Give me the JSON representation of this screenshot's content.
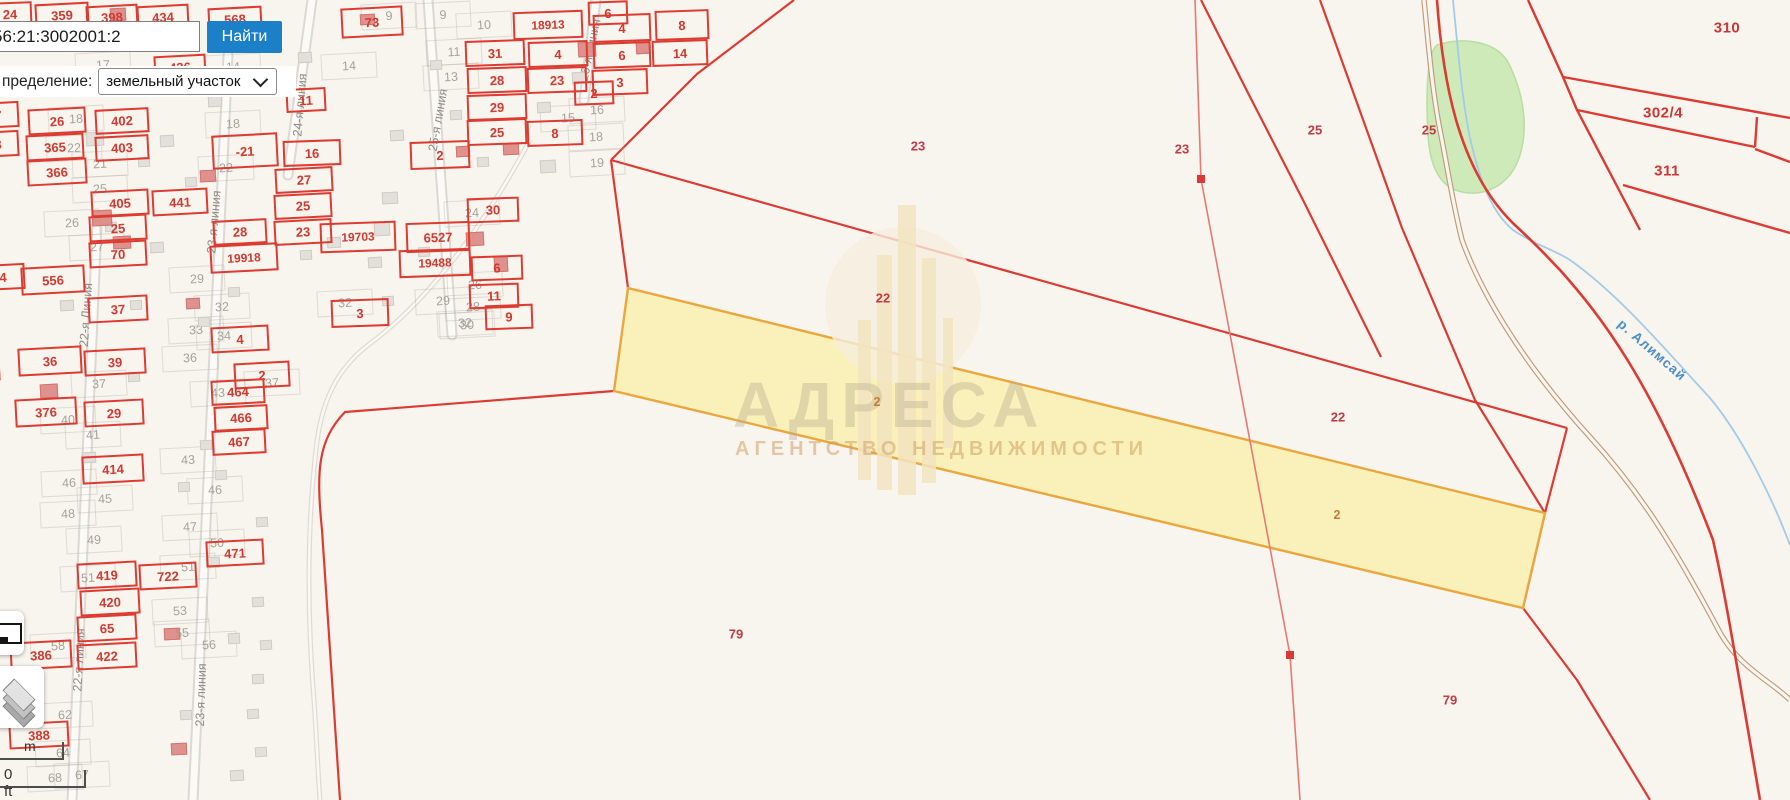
{
  "search": {
    "value": "56:21:3002001:2",
    "button_label": "Найти",
    "filter_label": "пределение:",
    "filter_value": "земельный участок"
  },
  "controls": {
    "scale_m": "m",
    "scale_ft": "0 ft",
    "icons": {
      "layers": "layers-icon",
      "minimap": "minimap-icon",
      "dropdown": "chevron-down-icon"
    }
  },
  "watermark": {
    "title": "АДРЕСА",
    "subtitle": "АГЕНТСТВО НЕДВИЖИМОСТИ"
  },
  "colors": {
    "parcel_red": "#dd3b31",
    "selected_fill": "#f9efab",
    "selected_border": "#eba63e",
    "accent_blue": "#1c80c9",
    "river_blue": "#a3cbe9",
    "green_area": "#cdeab8"
  },
  "map": {
    "river_label": "р. Алимсай",
    "selected_parcel_label": "2",
    "parcels": [
      [
        "24",
        10,
        14,
        44,
        24,
        -2
      ],
      [
        "359",
        62,
        15,
        54,
        24,
        -3
      ],
      [
        "398",
        112,
        17,
        52,
        24,
        -3
      ],
      [
        "434",
        163,
        17,
        52,
        24,
        -3
      ],
      [
        "568",
        235,
        19,
        54,
        24,
        -3
      ],
      [
        "73",
        372,
        22,
        62,
        30,
        -3
      ],
      [
        "18913",
        548,
        25,
        70,
        28,
        -2
      ],
      [
        "4",
        622,
        28,
        58,
        28,
        -2
      ],
      [
        "8",
        682,
        25,
        54,
        30,
        -2
      ],
      [
        "31",
        495,
        53,
        60,
        26,
        -2
      ],
      [
        "4",
        558,
        54,
        60,
        26,
        -2
      ],
      [
        "6",
        622,
        55,
        58,
        26,
        -2
      ],
      [
        "14",
        680,
        53,
        56,
        26,
        -2
      ],
      [
        "28",
        497,
        80,
        60,
        26,
        -2
      ],
      [
        "23",
        557,
        80,
        60,
        26,
        -2
      ],
      [
        "3",
        620,
        82,
        56,
        26,
        -2
      ],
      [
        "29",
        497,
        107,
        60,
        26,
        -2
      ],
      [
        "25",
        497,
        132,
        60,
        26,
        -2
      ],
      [
        "8",
        555,
        133,
        56,
        26,
        -2
      ],
      [
        "436",
        180,
        67,
        52,
        24,
        -3
      ],
      [
        "11",
        306,
        100,
        40,
        24,
        -3
      ],
      [
        "26",
        57,
        121,
        58,
        26,
        -3
      ],
      [
        "402",
        122,
        121,
        54,
        25,
        -3
      ],
      [
        "7",
        -2,
        115,
        42,
        26,
        -3
      ],
      [
        "365",
        55,
        147,
        58,
        26,
        -3
      ],
      [
        "8",
        -2,
        144,
        42,
        26,
        -3
      ],
      [
        "403",
        122,
        148,
        54,
        25,
        -3
      ],
      [
        "366",
        57,
        172,
        60,
        26,
        -3
      ],
      [
        "-21",
        245,
        151,
        66,
        34,
        -3
      ],
      [
        "27",
        304,
        180,
        58,
        25,
        -3
      ],
      [
        "25",
        303,
        206,
        58,
        25,
        -3
      ],
      [
        "23",
        303,
        232,
        58,
        25,
        -3
      ],
      [
        "441",
        180,
        202,
        56,
        26,
        -3
      ],
      [
        "405",
        120,
        203,
        58,
        26,
        -3
      ],
      [
        "25",
        118,
        228,
        58,
        26,
        -3
      ],
      [
        "70",
        118,
        254,
        58,
        26,
        -3
      ],
      [
        "28",
        240,
        232,
        54,
        25,
        -3
      ],
      [
        "19918",
        244,
        258,
        68,
        28,
        -3
      ],
      [
        "19703",
        358,
        237,
        76,
        30,
        -2
      ],
      [
        "6527",
        438,
        237,
        64,
        30,
        -2
      ],
      [
        "19488",
        435,
        263,
        72,
        28,
        -2
      ],
      [
        "30",
        493,
        210,
        52,
        25,
        -2
      ],
      [
        "6",
        497,
        268,
        52,
        25,
        -2
      ],
      [
        "11",
        494,
        296,
        50,
        25,
        -2
      ],
      [
        "9",
        509,
        317,
        48,
        25,
        -2
      ],
      [
        "3",
        360,
        313,
        58,
        28,
        -2
      ],
      [
        "16",
        312,
        153,
        58,
        26,
        -2
      ],
      [
        "2",
        440,
        155,
        60,
        28,
        -2
      ],
      [
        "4",
        3,
        277,
        44,
        26,
        -3
      ],
      [
        "556",
        53,
        280,
        64,
        28,
        -3
      ],
      [
        "37",
        118,
        309,
        60,
        26,
        -3
      ],
      [
        "36",
        50,
        361,
        64,
        28,
        -3
      ],
      [
        "39",
        115,
        362,
        62,
        26,
        -3
      ],
      [
        "376",
        46,
        412,
        62,
        28,
        -3
      ],
      [
        "29",
        114,
        413,
        60,
        26,
        -3
      ],
      [
        "4",
        240,
        339,
        58,
        26,
        -3
      ],
      [
        "2",
        262,
        375,
        56,
        26,
        -3
      ],
      [
        "464",
        238,
        392,
        54,
        25,
        -3
      ],
      [
        "466",
        241,
        418,
        54,
        25,
        -3
      ],
      [
        "467",
        239,
        442,
        54,
        25,
        -3
      ],
      [
        "414",
        113,
        469,
        62,
        28,
        -3
      ],
      [
        "471",
        235,
        553,
        58,
        26,
        -3
      ],
      [
        "419",
        107,
        575,
        60,
        26,
        -3
      ],
      [
        "722",
        168,
        576,
        58,
        26,
        -3
      ],
      [
        "420",
        110,
        602,
        60,
        26,
        -3
      ],
      [
        "65",
        107,
        628,
        60,
        26,
        -3
      ],
      [
        "386",
        41,
        655,
        62,
        28,
        -3
      ],
      [
        "422",
        107,
        656,
        60,
        26,
        -3
      ],
      [
        "388",
        39,
        735,
        60,
        26,
        -3
      ],
      [
        "",
        -14,
        368,
        28,
        26,
        -3
      ],
      [
        "",
        -16,
        401,
        28,
        28,
        -3
      ],
      [
        "6",
        608,
        13,
        40,
        24,
        -2
      ],
      [
        "2",
        594,
        93,
        40,
        24,
        -2
      ]
    ],
    "gray_numbers": [
      [
        "17",
        103,
        65
      ],
      [
        "14",
        233,
        67
      ],
      [
        "14",
        349,
        66
      ],
      [
        "9",
        389,
        16
      ],
      [
        "9",
        443,
        15
      ],
      [
        "10",
        484,
        25
      ],
      [
        "11",
        454,
        52
      ],
      [
        "13",
        451,
        77
      ],
      [
        "15",
        568,
        118
      ],
      [
        "16",
        597,
        110
      ],
      [
        "18",
        596,
        137
      ],
      [
        "19",
        597,
        163
      ],
      [
        "18",
        76,
        119
      ],
      [
        "22",
        74,
        148
      ],
      [
        "21",
        100,
        164
      ],
      [
        "18",
        233,
        124
      ],
      [
        "22",
        226,
        168
      ],
      [
        "25",
        100,
        189
      ],
      [
        "26",
        72,
        223
      ],
      [
        "27",
        97,
        247
      ],
      [
        "29",
        197,
        279
      ],
      [
        "32",
        222,
        307
      ],
      [
        "33",
        196,
        330
      ],
      [
        "34",
        224,
        336
      ],
      [
        "36",
        190,
        358
      ],
      [
        "37",
        99,
        384
      ],
      [
        "37",
        272,
        383
      ],
      [
        "40",
        68,
        420
      ],
      [
        "41",
        93,
        435
      ],
      [
        "43",
        188,
        460
      ],
      [
        "43",
        218,
        393
      ],
      [
        "46",
        69,
        483
      ],
      [
        "46",
        215,
        490
      ],
      [
        "45",
        105,
        499
      ],
      [
        "48",
        68,
        514
      ],
      [
        "47",
        190,
        527
      ],
      [
        "49",
        94,
        540
      ],
      [
        "50",
        217,
        543
      ],
      [
        "51",
        88,
        578
      ],
      [
        "51",
        188,
        567
      ],
      [
        "53",
        180,
        611
      ],
      [
        "55",
        182,
        633
      ],
      [
        "56",
        209,
        645
      ],
      [
        "58",
        58,
        646
      ],
      [
        "62",
        65,
        715
      ],
      [
        "64",
        63,
        753
      ],
      [
        "67",
        82,
        775
      ],
      [
        "68",
        55,
        778
      ],
      [
        "24",
        472,
        213
      ],
      [
        "26",
        475,
        285
      ],
      [
        "28",
        473,
        307
      ],
      [
        "29",
        443,
        301
      ],
      [
        "30",
        467,
        325
      ],
      [
        "32",
        345,
        303
      ],
      [
        "32",
        465,
        323
      ]
    ],
    "area_labels": [
      [
        "23",
        918,
        146,
        "p"
      ],
      [
        "23",
        1182,
        149,
        "p"
      ],
      [
        "25",
        1315,
        130,
        "p"
      ],
      [
        "22",
        883,
        298,
        "p"
      ],
      [
        "22",
        1338,
        417,
        "p"
      ],
      [
        "2",
        877,
        402,
        "o"
      ],
      [
        "2",
        1337,
        515,
        "o"
      ],
      [
        "79",
        736,
        634,
        "p"
      ],
      [
        "79",
        1450,
        700,
        "p"
      ],
      [
        "310",
        1727,
        28,
        "g"
      ],
      [
        "302/4",
        1663,
        113,
        "g"
      ],
      [
        "311",
        1667,
        171,
        "g"
      ],
      [
        "25",
        1429,
        130,
        "p"
      ]
    ],
    "street_names": [
      [
        "22-я Линия",
        86,
        315,
        -86
      ],
      [
        "22-я линия",
        79,
        660,
        -87
      ],
      [
        "23-я линия",
        214,
        222,
        -85
      ],
      [
        "23-я линия",
        201,
        695,
        -88
      ],
      [
        "24-я линия",
        300,
        105,
        -85
      ],
      [
        "25-я линия",
        438,
        120,
        -80
      ],
      [
        "26-я линия",
        590,
        50,
        -78
      ]
    ],
    "buildings_red": [
      [
        110,
        8,
        14,
        11
      ],
      [
        360,
        14,
        13,
        9
      ],
      [
        578,
        42,
        16,
        13
      ],
      [
        503,
        143,
        14,
        10
      ],
      [
        92,
        210,
        18,
        14
      ],
      [
        113,
        236,
        16,
        11
      ],
      [
        200,
        170,
        14,
        10
      ],
      [
        466,
        232,
        16,
        12
      ],
      [
        494,
        256,
        12,
        14
      ],
      [
        40,
        384,
        16,
        12
      ],
      [
        186,
        298,
        12,
        9
      ],
      [
        164,
        628,
        14,
        10
      ],
      [
        171,
        743,
        14,
        10
      ],
      [
        636,
        42,
        12,
        10
      ],
      [
        456,
        146,
        12,
        9
      ]
    ],
    "buildings_gray": [
      [
        215,
        36,
        14,
        10
      ],
      [
        298,
        52,
        12,
        9
      ],
      [
        86,
        132,
        16,
        12
      ],
      [
        138,
        157,
        10,
        8
      ],
      [
        208,
        96,
        12,
        9
      ],
      [
        382,
        296,
        10,
        8
      ],
      [
        228,
        287,
        10,
        8
      ],
      [
        382,
        192,
        14,
        10
      ],
      [
        368,
        257,
        12,
        9
      ],
      [
        128,
        372,
        10,
        8
      ],
      [
        198,
        317,
        10,
        8
      ],
      [
        82,
        452,
        12,
        9
      ],
      [
        178,
        482,
        10,
        8
      ],
      [
        256,
        517,
        10,
        8
      ],
      [
        206,
        557,
        12,
        9
      ],
      [
        252,
        597,
        10,
        8
      ],
      [
        228,
        633,
        10,
        9
      ],
      [
        252,
        674,
        10,
        8
      ],
      [
        247,
        709,
        10,
        8
      ],
      [
        255,
        747,
        10,
        8
      ],
      [
        185,
        177,
        10,
        8
      ],
      [
        160,
        135,
        12,
        10
      ],
      [
        105,
        222,
        10,
        8
      ],
      [
        150,
        242,
        12,
        9
      ],
      [
        374,
        222,
        14,
        12
      ],
      [
        418,
        247,
        10,
        8
      ],
      [
        572,
        72,
        12,
        10
      ],
      [
        537,
        102,
        12,
        9
      ],
      [
        477,
        157,
        10,
        8
      ],
      [
        327,
        237,
        12,
        9
      ],
      [
        540,
        160,
        14,
        11
      ],
      [
        450,
        110,
        10,
        8
      ],
      [
        130,
        300,
        10,
        8
      ],
      [
        60,
        300,
        12,
        9
      ],
      [
        200,
        440,
        10,
        8
      ],
      [
        215,
        470,
        10,
        8
      ],
      [
        260,
        640,
        10,
        8
      ],
      [
        230,
        770,
        12,
        9
      ],
      [
        180,
        710,
        10,
        8
      ],
      [
        430,
        60,
        10,
        8
      ],
      [
        390,
        130,
        12,
        9
      ],
      [
        300,
        250,
        10,
        8
      ]
    ]
  }
}
